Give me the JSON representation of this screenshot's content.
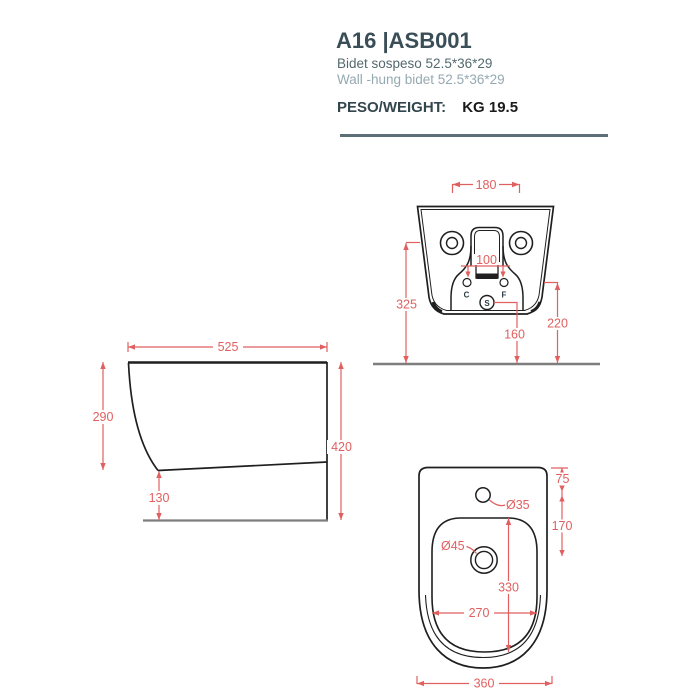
{
  "header": {
    "title": "A16 |ASB001",
    "subtitle_it": "Bidet sospeso 52.5*36*29",
    "subtitle_en": "Wall -hung bidet 52.5*36*29",
    "weight_label": "PESO/WEIGHT:",
    "weight_value": "KG 19.5"
  },
  "colors": {
    "accent_red": "#e06060",
    "title_slate": "#3a4e57",
    "subtitle_gray": "#54696f",
    "subtitle_light": "#95a9b1",
    "floor_gray": "#7e7e7e",
    "outline_black": "#1f1f1f"
  },
  "views": {
    "rear": {
      "dims": {
        "mount_width": "180",
        "holes_span": "100",
        "height_left": "325",
        "height_right": "220",
        "drain_height": "160"
      },
      "labels": {
        "c": "C",
        "f": "F",
        "s": "S"
      }
    },
    "side": {
      "dims": {
        "depth": "525",
        "front_height": "290",
        "total_height": "420",
        "bottom_clearance": "130"
      }
    },
    "top": {
      "dims": {
        "faucet_hole": "Ø35",
        "drain_hole": "Ø45",
        "edge_to_faucet": "75",
        "faucet_to_drain": "170",
        "basin_length": "330",
        "basin_width": "270",
        "overall_width": "360"
      }
    }
  }
}
